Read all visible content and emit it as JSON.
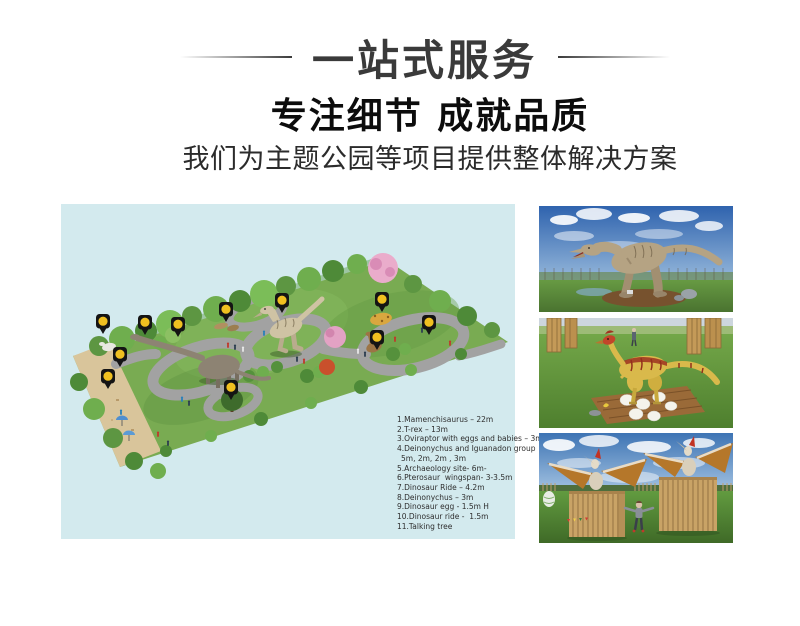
{
  "header": {
    "banner": "一站式服务",
    "heading": "专注细节 成就品质",
    "subheading": "我们为主题公园等项目提供整体解决方案"
  },
  "map": {
    "panel_bg": "#d3eaee",
    "pin_color": "#f0c020",
    "pin_count": 11,
    "legend": [
      "1.Mamenchisaurus – 22m",
      "2.T-rex – 13m",
      "3.Oviraptor with eggs and babies – 3m",
      "4.Deinonychus and Iguanadon group",
      "5m, 2m, 2m , 3m",
      "5.Archaeology site- 6m-",
      "6.Pterosaur  wingspan- 3-3.5m",
      "7.Dinosaur Ride – 4.2m",
      "8.Deinonychus – 3m",
      "9.Dinosaur egg - 1.5m H",
      "10.Dinosaur ride -  1.5m",
      "11.Talking tree"
    ]
  },
  "photos": {
    "trex": {
      "alt": "Animatronic T-rex statue in outdoor dinosaur park"
    },
    "oviraptor": {
      "alt": "Oviraptor animatronic guarding nest of eggs"
    },
    "pterosaur": {
      "alt": "Two pterosaur models on wooden stands with child posing"
    }
  }
}
